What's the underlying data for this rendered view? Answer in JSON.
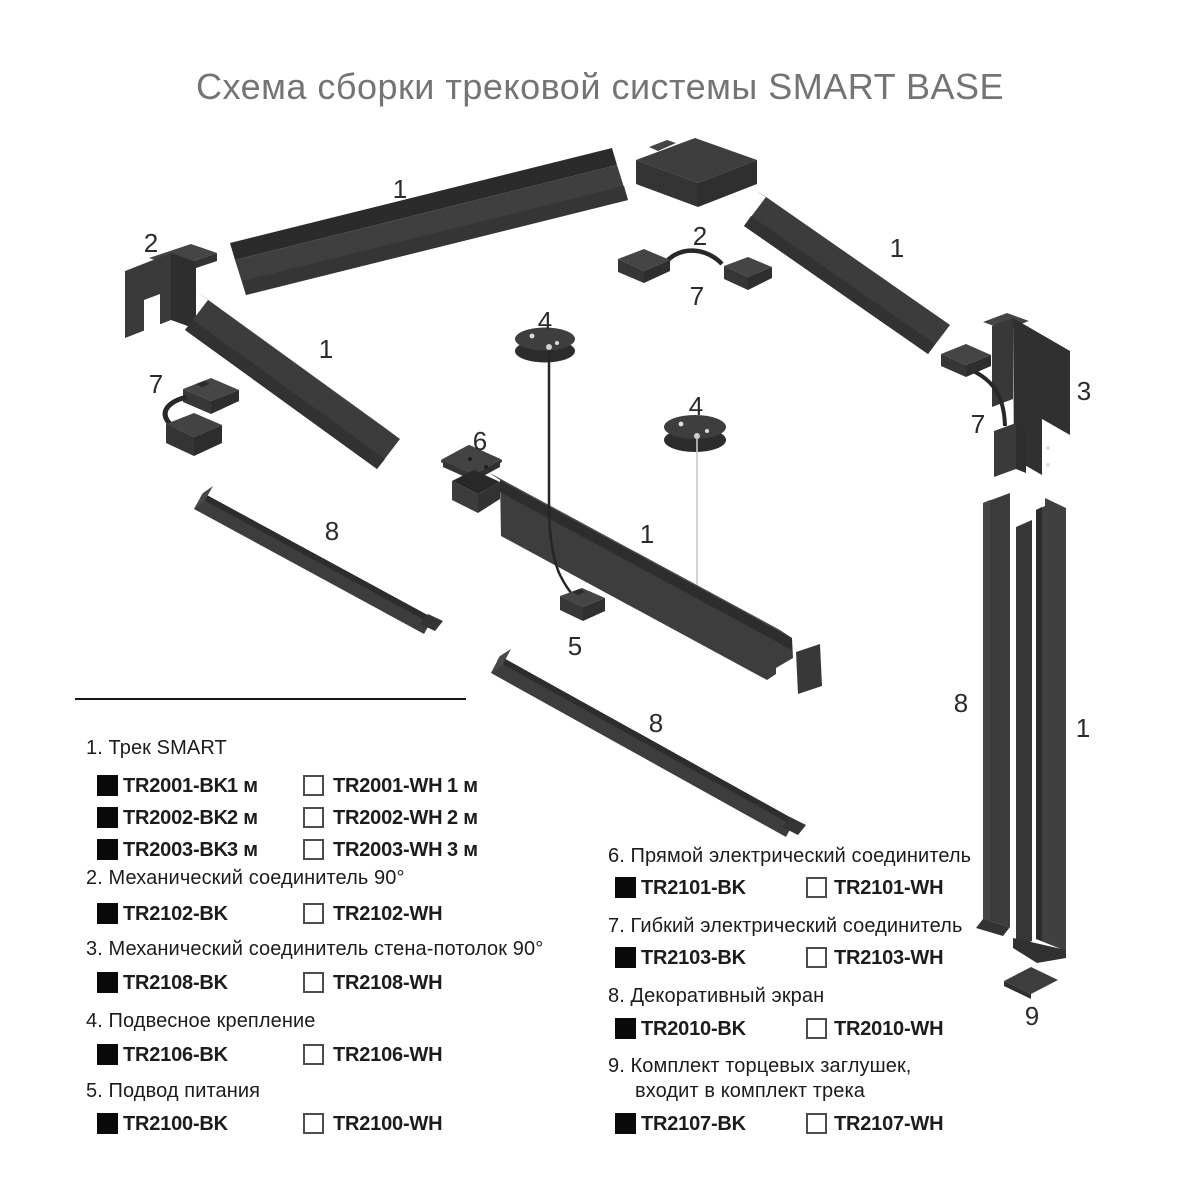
{
  "title": "Схема сборки трековой системы SMART BASE",
  "colors": {
    "background": "#ffffff",
    "part_dark": "#3d3d3d",
    "part_darker": "#2d2d2d",
    "part_light_face": "#4a4a4a",
    "title_text": "#747474",
    "legend_text": "#1c1c1c",
    "cable_dark": "#282828",
    "cable_light": "#c8c8c8"
  },
  "diagram": {
    "labels": [
      "1",
      "2",
      "1",
      "7",
      "2",
      "7",
      "1",
      "4",
      "3",
      "7",
      "4",
      "6",
      "1",
      "8",
      "5",
      "8",
      "8",
      "1",
      "9"
    ]
  },
  "legend": {
    "left": [
      {
        "title": "1. Трек SMART",
        "rows": [
          {
            "bk": "TR2001-BK",
            "bk_size": "1 м",
            "wh": "TR2001-WH",
            "wh_size": "1 м"
          },
          {
            "bk": "TR2002-BK",
            "bk_size": "2 м",
            "wh": "TR2002-WH",
            "wh_size": "2 м"
          },
          {
            "bk": "TR2003-BK",
            "bk_size": "3 м",
            "wh": "TR2003-WH",
            "wh_size": "3 м"
          }
        ]
      },
      {
        "title": "2. Механический соединитель 90°",
        "rows": [
          {
            "bk": "TR2102-BK",
            "wh": "TR2102-WH"
          }
        ]
      },
      {
        "title": "3. Механический соединитель стена-потолок 90°",
        "rows": [
          {
            "bk": "TR2108-BK",
            "wh": "TR2108-WH"
          }
        ]
      },
      {
        "title": "4. Подвесное крепление",
        "rows": [
          {
            "bk": "TR2106-BK",
            "wh": "TR2106-WH"
          }
        ]
      },
      {
        "title": "5. Подвод питания",
        "rows": [
          {
            "bk": "TR2100-BK",
            "wh": "TR2100-WH"
          }
        ]
      }
    ],
    "right": [
      {
        "title": "6. Прямой электрический соединитель",
        "rows": [
          {
            "bk": "TR2101-BK",
            "wh": "TR2101-WH"
          }
        ]
      },
      {
        "title": "7. Гибкий электрический соединитель",
        "rows": [
          {
            "bk": "TR2103-BK",
            "wh": "TR2103-WH"
          }
        ]
      },
      {
        "title": "8. Декоративный экран",
        "rows": [
          {
            "bk": "TR2010-BK",
            "wh": "TR2010-WH"
          }
        ]
      },
      {
        "title": "9. Комплект торцевых заглушек,",
        "title_line2": "входит в комплект трека",
        "rows": [
          {
            "bk": "TR2107-BK",
            "wh": "TR2107-WH"
          }
        ]
      }
    ]
  }
}
